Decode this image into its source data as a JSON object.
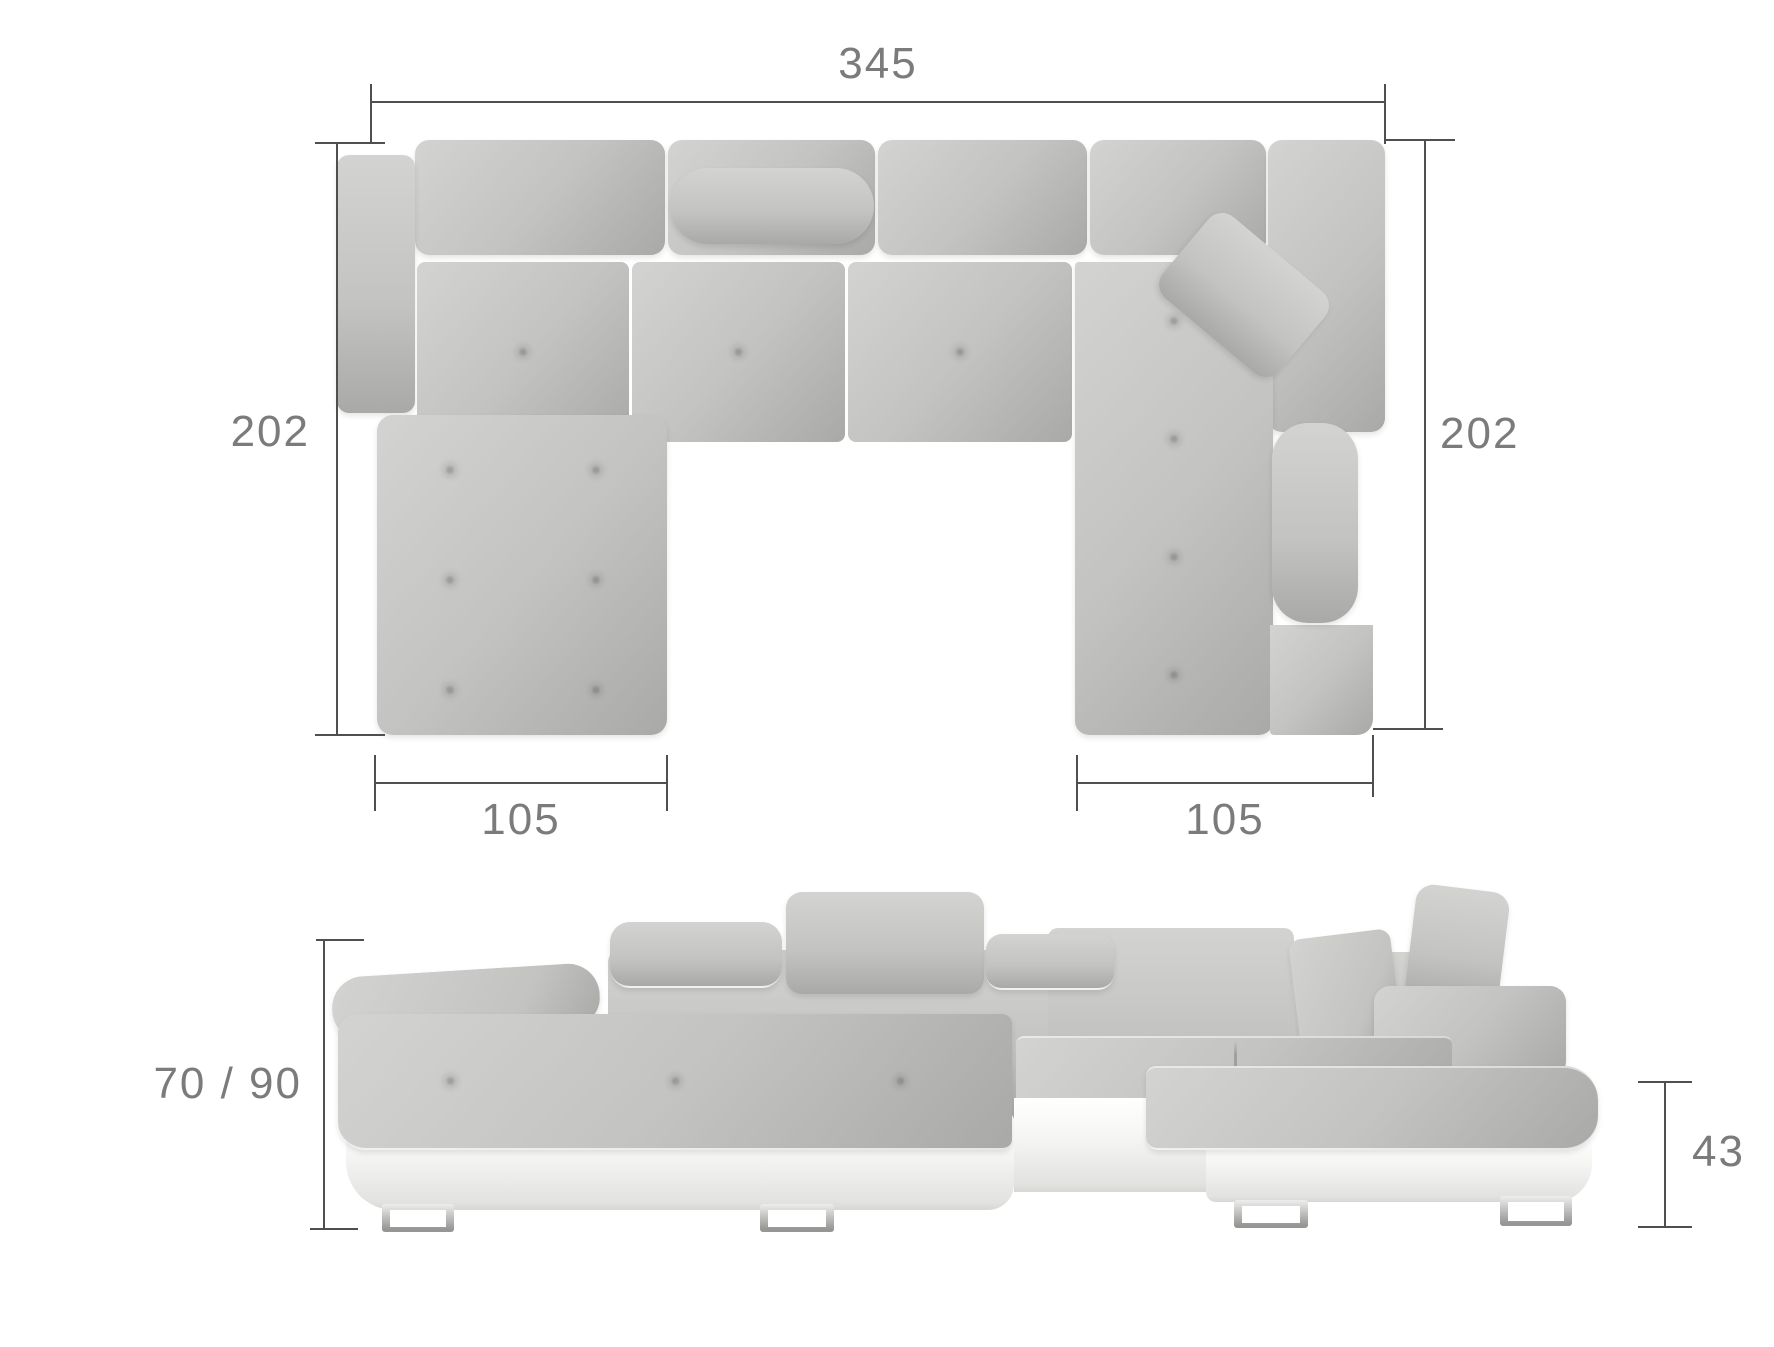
{
  "dimensions": {
    "total_width": "345",
    "left_depth": "202",
    "right_depth": "202",
    "left_chaise_width": "105",
    "right_chaise_width": "105",
    "height_range": "70 / 90",
    "seat_height": "43"
  },
  "colors": {
    "fabric_light": "#d3d3d1",
    "fabric_mid": "#c3c3c1",
    "fabric_dark": "#a9a9a7",
    "base_white": "#f6f6f4",
    "base_shadow": "#e2e2e0",
    "chrome_light": "#eeeeec",
    "chrome_dark": "#969694",
    "dim_line": "#4f4f4f",
    "dim_text": "#7b7b7b"
  }
}
